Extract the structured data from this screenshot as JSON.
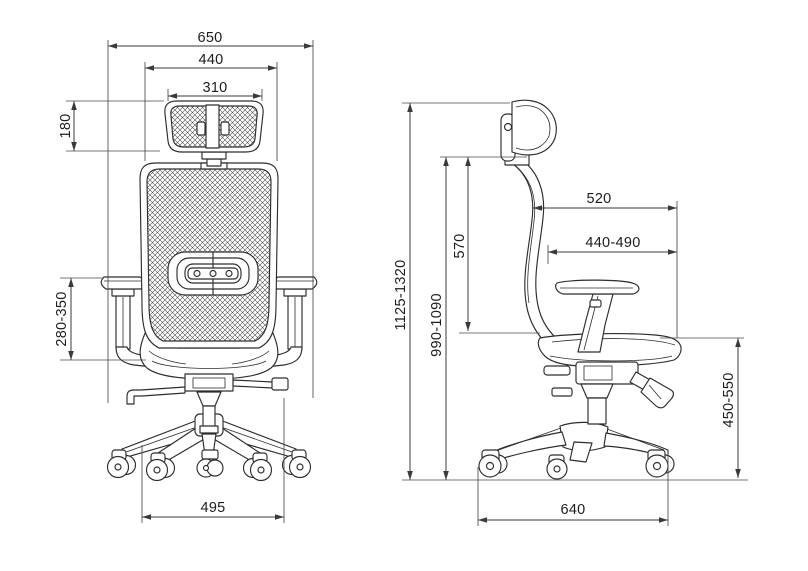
{
  "diagram": {
    "subject": "office chair technical dimension drawing, front view and side view",
    "front": {
      "overall_width": "650",
      "backrest_width": "440",
      "headrest_width": "310",
      "headrest_height": "180",
      "armrest_height": "280-350",
      "base_width": "495"
    },
    "side": {
      "overall_height": "1125-1320",
      "back_height": "990-1090",
      "backrest_height": "570",
      "seat_total_depth": "520",
      "seat_depth": "440-490",
      "seat_height": "450-550",
      "base_depth": "640"
    },
    "colors": {
      "line": "#2d2d2d",
      "dimension": "#3a3a3a",
      "background": "#ffffff"
    }
  }
}
